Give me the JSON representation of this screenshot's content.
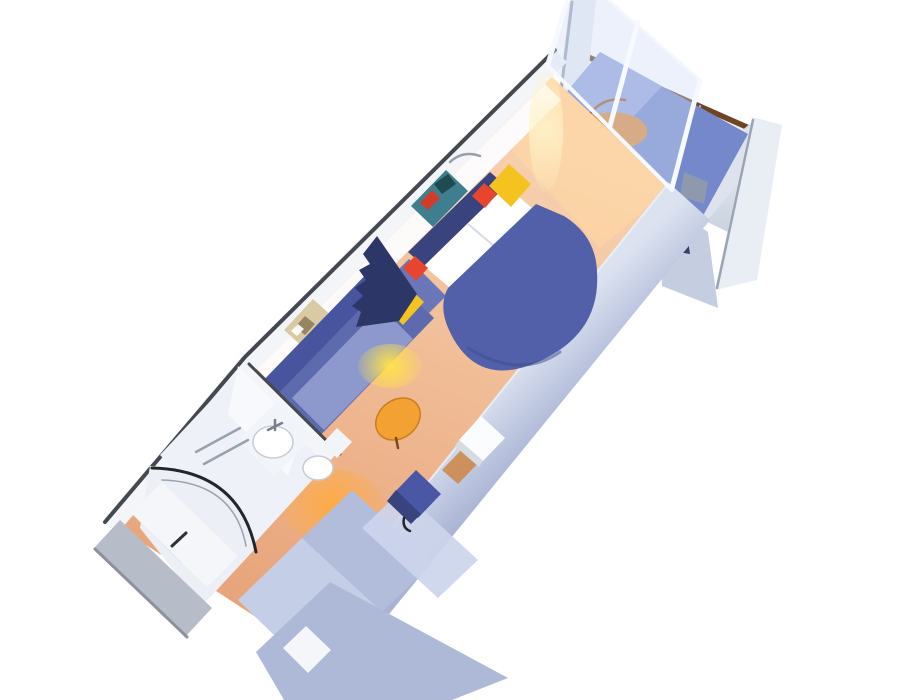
{
  "scene": {
    "description": "3D isometric cutaway rendering of a cruise ship balcony stateroom",
    "view": "angled top-down cutaway, room axis running from lower-left entrance to upper-right balcony",
    "rooms": [
      "entrance-corridor",
      "bathroom",
      "sitting-area",
      "bedroom",
      "private-balcony"
    ],
    "furniture": [
      "entrance-door",
      "wardrobe-closet",
      "shower-stall",
      "washbasin",
      "toilet",
      "blue-sofa",
      "orange-oval-ottoman",
      "navy-divider-curtain",
      "wall-painting-over-sofa",
      "round-foot-double-bed",
      "white-pillows",
      "yellow-nightstand-left",
      "yellow-nightstand-right",
      "red-accent-cushion-left",
      "red-accent-cushion-right",
      "wall-painting-over-bed",
      "wooden-desk",
      "white-tv-cabinet",
      "blue-desk-chair",
      "sliding-glass-balcony-door",
      "balcony-wood-lounger",
      "balcony-table",
      "balcony-privacy-panel",
      "balcony-railing",
      "balcony-divider-fins"
    ]
  },
  "colors": {
    "background": "#ffffff",
    "floor_light": "#f8d2b0",
    "floor_dark": "#e8a57b",
    "sun_patch": "#ffd9a2",
    "wall_outer": "#f3f5f9",
    "wall_cap": "#44494f",
    "wall_inner": "#fdfdff",
    "wall_band_light": "#dce2f0",
    "wall_band_dark": "#a8b3d4",
    "wall_band_hi": "#eef1f8",
    "fin": "#e9edf4",
    "fin_edge": "#9aa4b4",
    "rail_cap": "#6f4526",
    "rail_mullion": "#aeb6c6",
    "rail_light": "#ffffff",
    "rail_dark": "#c7d0df",
    "balcony_wall": "#dde2ee",
    "balcony_wall2": "#c5cde0",
    "balcony_floor": "#7488cb",
    "balcony_floor_light": "#9fafe2",
    "balcony_cabinet": "#8e99ad",
    "balcony_table": "#6e7a94",
    "privacy_panel": "#323e6d",
    "lounger": "#d98c3c",
    "lounger_edge": "#a06020",
    "glass": "#cfdcf5",
    "glass_frame": "#f6f9fd",
    "bed": "#5160a8",
    "bed_shade": "#3e4a8c",
    "headboard": "#39437e",
    "pillow": "#ffffff",
    "pillow_shadow": "#d5dae4",
    "nightstand": "#f4c31f",
    "nightstand_edge": "#c79a10",
    "cushion": "#e8452e",
    "curtain": "#2c3768",
    "sofa": "#5e6aae",
    "sofa_dark": "#49549e",
    "sofa_cushion": "#8d99cc",
    "sofa_arm": "#6b76b8",
    "ottoman": "#f2a132",
    "ottoman_edge": "#c97f1d",
    "ottoman_leg": "#7a4a1e",
    "painting1": "#d9caa4",
    "painting1_frame": "#a8946a",
    "painting1_art": "#8a7a55",
    "painting1_hi": "#ffffff",
    "painting2": "#3e7e8e",
    "painting2_frame": "#b5924e",
    "painting2_red": "#d23c28",
    "painting2_dark": "#1e4a50",
    "bath_floor": "#eef2f8",
    "bath_wall": "#f7f9fc",
    "shower_floor": "#eceff5",
    "shower_frame": "#23262b",
    "shower_frame2": "#9aa3ad",
    "bath_step": "#dfe3ea",
    "bath_counter": "#f1f4f9",
    "basin": "#ffffff",
    "basin_edge": "#c6ccd6",
    "faucet": "#777f8a",
    "towel_bar": "#99a1ac",
    "desk": "#cc8a4e",
    "tv": "#fbfcfe",
    "tv_side": "#d7dce4",
    "wardrobe1": "#c5cee7",
    "wardrobe2": "#b2bddc",
    "wardrobe3": "#ccd5ec",
    "wardrobe4": "#aeb9d8",
    "chair": "#4a57a5",
    "chair_dark": "#39437e",
    "chair_leg": "#22252c",
    "threshold": "#b7bdc8",
    "threshold_edge": "#8b919d",
    "door_panel": "#f4f6fa",
    "door_frame": "#9aa3ae",
    "handle": "#2d3138",
    "lamp_swoosh": "#98a0ac",
    "glow_yellow": "#ffe24a",
    "glow_warm": "#ffab45",
    "sun_glow": "#fff3c8"
  }
}
